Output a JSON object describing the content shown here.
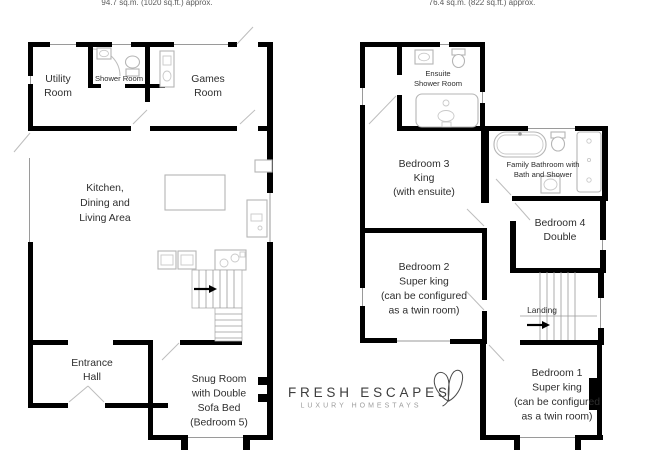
{
  "document": {
    "type": "floor-plan",
    "background": "#ffffff"
  },
  "ground_floor": {
    "area_label": "94.7 sq.m. (1020 sq.ft.) approx.",
    "rooms": {
      "utility": {
        "label_lines": [
          "Utility",
          "Room"
        ]
      },
      "shower_room": {
        "label_lines": [
          "Shower Room"
        ]
      },
      "games": {
        "label_lines": [
          "Games",
          "Room"
        ]
      },
      "kitchen_dining_living": {
        "label_lines": [
          "Kitchen,",
          "Dining and",
          "Living Area"
        ]
      },
      "entrance_hall": {
        "label_lines": [
          "Entrance",
          "Hall"
        ]
      },
      "snug": {
        "label_lines": [
          "Snug Room",
          "with Double",
          "Sofa Bed",
          "(Bedroom 5)"
        ]
      }
    }
  },
  "first_floor": {
    "area_label": "76.4 sq.m. (822 sq.ft.) approx.",
    "rooms": {
      "ensuite_shower_room": {
        "label_lines": [
          "Ensuite",
          "Shower Room"
        ]
      },
      "bedroom_3": {
        "label_lines": [
          "Bedroom 3",
          "King",
          "(with ensuite)"
        ]
      },
      "family_bathroom": {
        "label_lines": [
          "Family Bathroom with",
          "Bath and Shower"
        ]
      },
      "bedroom_4": {
        "label_lines": [
          "Bedroom 4",
          "Double"
        ]
      },
      "bedroom_2": {
        "label_lines": [
          "Bedroom 2",
          "Super king",
          "(can be configured",
          "as a twin room)"
        ]
      },
      "landing": {
        "label_lines": [
          "Landing"
        ]
      },
      "bedroom_1": {
        "label_lines": [
          "Bedroom 1",
          "Super king",
          "(can be configured",
          "as a twin room)"
        ]
      }
    }
  },
  "logo": {
    "name": "FRESH ESCAPES",
    "tagline": "LUXURY HOMESTAYS",
    "mark": "butterfly-icon"
  },
  "icons": {
    "ground_floor_stairs": "arrow-right",
    "first_floor_stairs": "arrow-right"
  },
  "colors": {
    "wall": "#000000",
    "label_text": "#2e2e2e",
    "area_text": "#5a5a5a",
    "fixture_outline": "#b5b5b5",
    "thin_line": "#9a9a9a",
    "door_swing": "#bdbdbd",
    "logo_text": "#3d3d3d",
    "logo_tagline": "#9c9c9c"
  }
}
